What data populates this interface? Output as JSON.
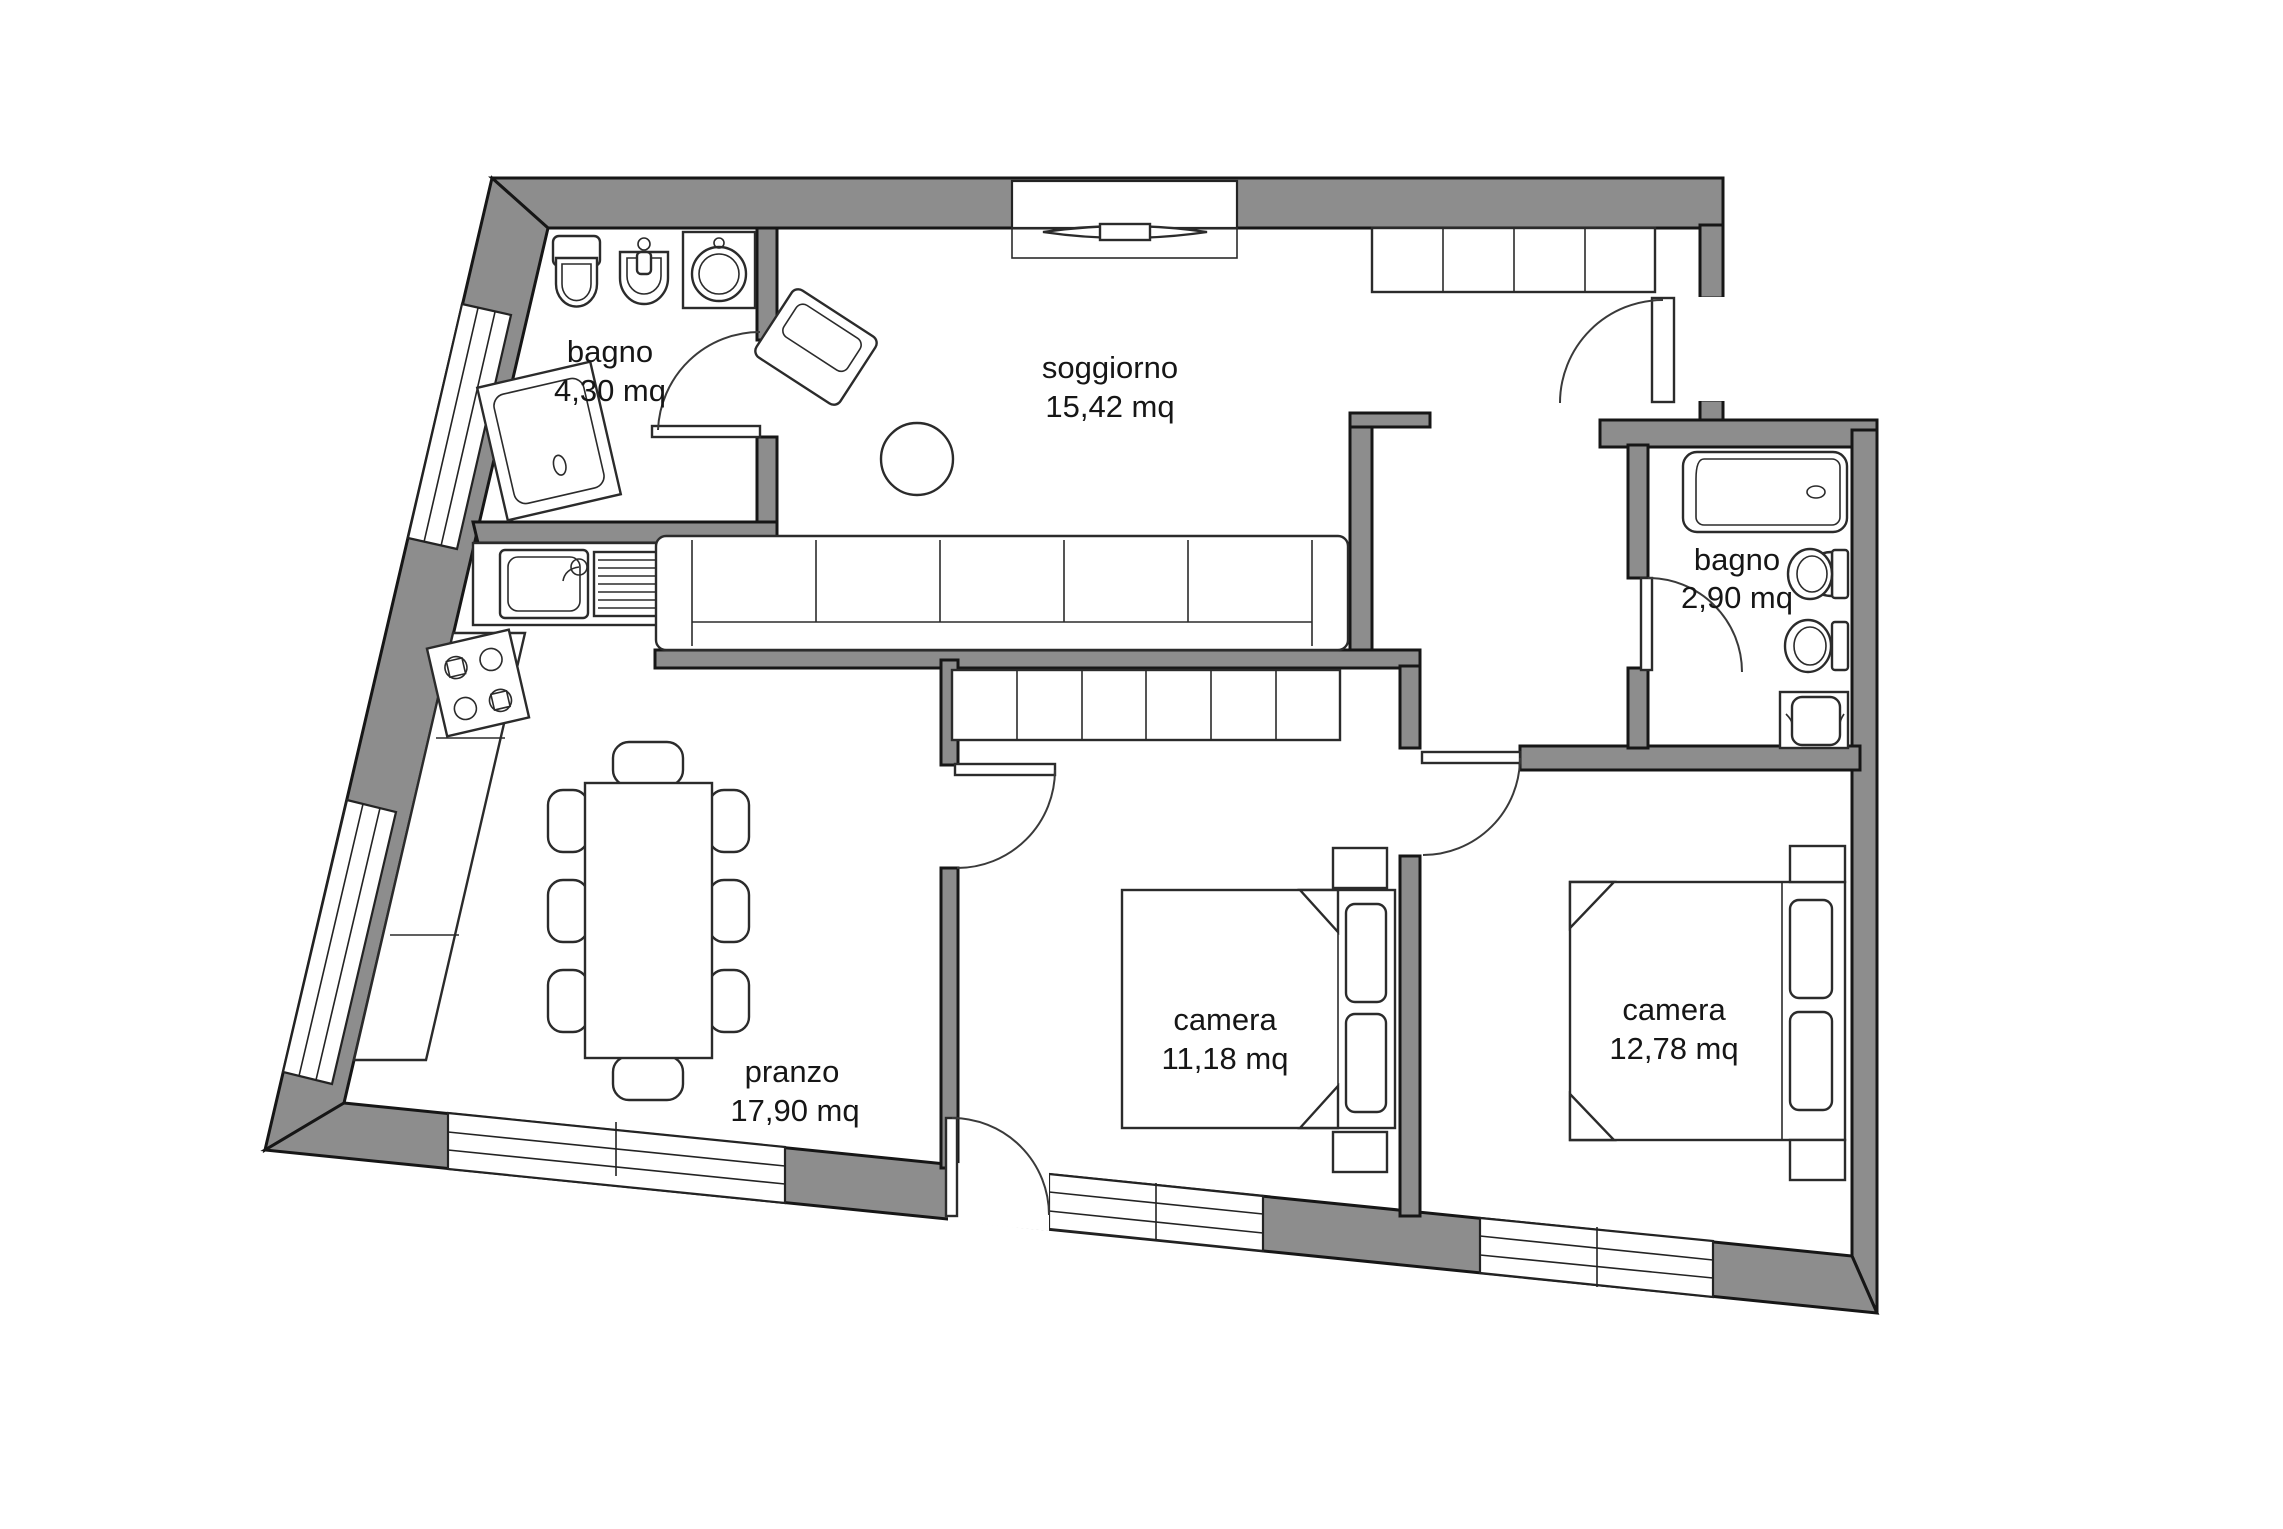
{
  "plan": {
    "colors": {
      "wall": "#8d8d8d",
      "ink": "#161616",
      "paper": "#ffffff"
    },
    "rooms": [
      {
        "id": "bagno-1",
        "name": "bagno",
        "area": "4,30 mq"
      },
      {
        "id": "soggiorno",
        "name": "soggiorno",
        "area": "15,42 mq"
      },
      {
        "id": "bagno-2",
        "name": "bagno",
        "area": "2,90 mq"
      },
      {
        "id": "camera-1",
        "name": "camera",
        "area": "11,18 mq"
      },
      {
        "id": "camera-2",
        "name": "camera",
        "area": "12,78 mq"
      },
      {
        "id": "pranzo",
        "name": "pranzo",
        "area": "17,90 mq"
      }
    ]
  }
}
